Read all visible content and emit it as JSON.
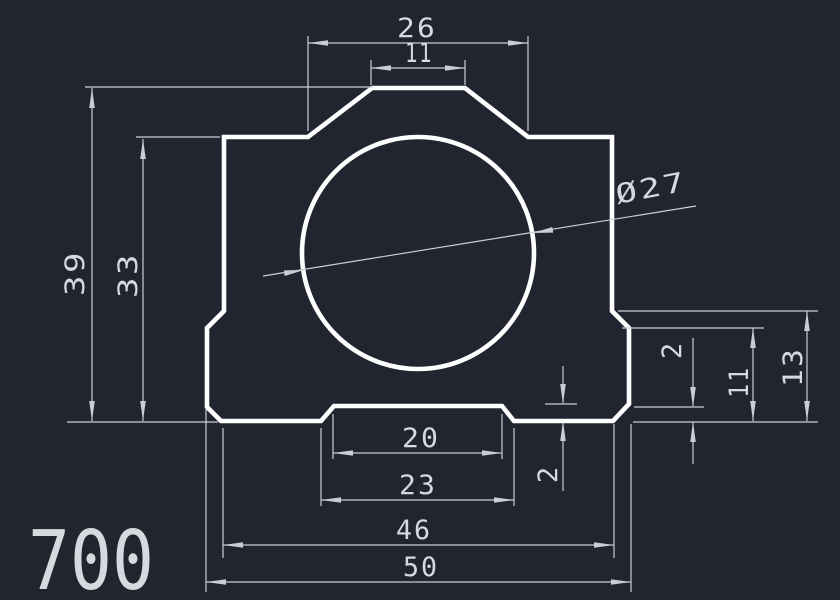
{
  "drawing": {
    "part_label": "700",
    "hole": {
      "diameter_label": "Ø27"
    },
    "dimensions": {
      "top_width_outer": "26",
      "top_width_inner": "11",
      "height_overall": "39",
      "height_body": "33",
      "step_height": "13",
      "flange_height": "11",
      "flange_chamfer": "2",
      "notch_depth": "2",
      "notch_width_inner": "20",
      "notch_width_outer": "23",
      "base_width_inner": "46",
      "base_width_outer": "50"
    },
    "colors": {
      "background": "#20252f",
      "outline": "#ffffff",
      "dim_lines": "#c9ced6",
      "text": "#d6dade"
    }
  }
}
